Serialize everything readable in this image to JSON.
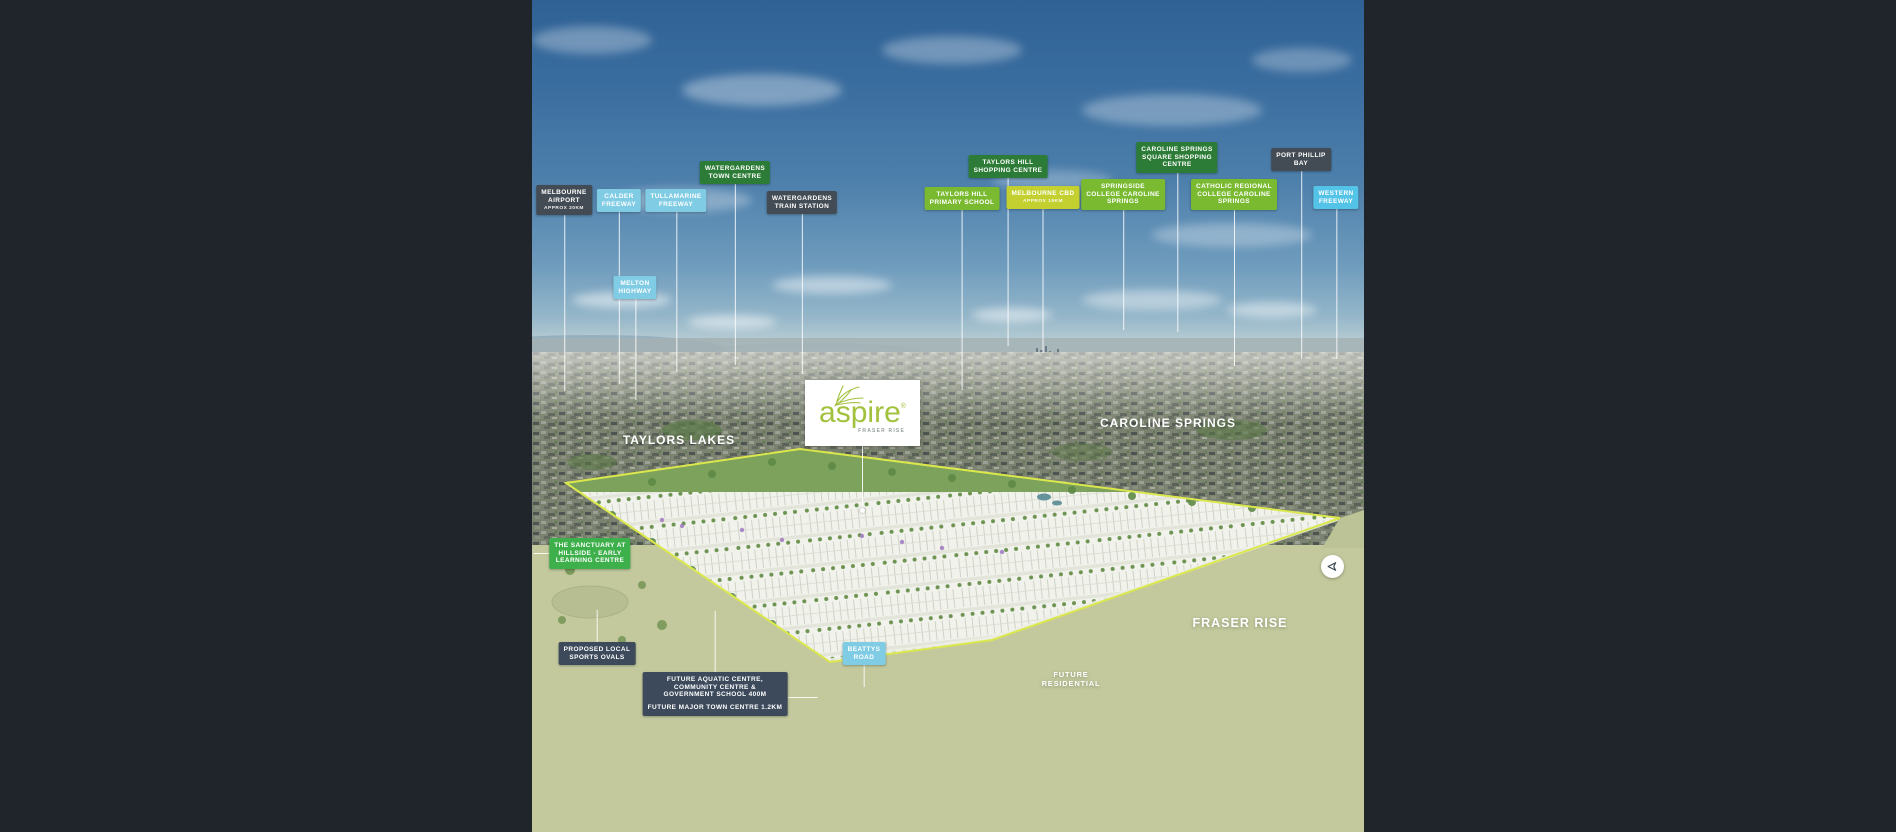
{
  "canvas": {
    "bg": "#20242b"
  },
  "palette": {
    "dark": "#434b54",
    "slate": "#3c4a5b",
    "blue": "#7fcce4",
    "cyan": "#54c3e8",
    "greenDark": "#2c7b36",
    "greenLight": "#7aba31",
    "greenBright": "#3eb04b",
    "yellow": "#c3d02f",
    "boundary": "#dbe84d",
    "leader": "rgba(255,255,255,0.85)"
  },
  "logo": {
    "brand": "aspire",
    "reg": "®",
    "sub": "FRASER RISE"
  },
  "share": {
    "icon": "send-icon"
  },
  "regions": [
    {
      "id": "taylors-lakes",
      "lines": [
        "TAYLORS LAKES"
      ],
      "cx": 147,
      "y": 433,
      "fs": 12,
      "ls": 1
    },
    {
      "id": "caroline-springs",
      "lines": [
        "CAROLINE SPRINGS"
      ],
      "cx": 636,
      "y": 416,
      "fs": 12,
      "ls": 1
    },
    {
      "id": "fraser-rise",
      "lines": [
        "FRASER RISE"
      ],
      "cx": 708,
      "y": 616,
      "fs": 12.5,
      "ls": 1
    },
    {
      "id": "future-residential",
      "lines": [
        "FUTURE",
        "RESIDENTIAL"
      ],
      "cx": 539,
      "y": 670,
      "fs": 7.5,
      "ls": 0.8
    }
  ],
  "callouts": [
    {
      "id": "melbourne-airport",
      "color": "dark",
      "cx": 32,
      "y": 185,
      "lines": [
        "MELBOURNE",
        "AIRPORT"
      ],
      "sub": "APPROX 20KM",
      "leaders": [
        {
          "dir": "down",
          "len": 176
        }
      ]
    },
    {
      "id": "calder-freeway",
      "color": "blue",
      "cx": 87,
      "y": 189,
      "lines": [
        "CALDER",
        "FREEWAY"
      ],
      "leaders": [
        {
          "dir": "down",
          "len": 172
        }
      ]
    },
    {
      "id": "tullamarine-freeway",
      "color": "blue",
      "cx": 144,
      "y": 189,
      "lines": [
        "TULLAMARINE",
        "FREEWAY"
      ],
      "leaders": [
        {
          "dir": "down",
          "len": 160
        }
      ]
    },
    {
      "id": "watergardens-town-centre",
      "color": "greenDark",
      "cx": 203,
      "y": 161,
      "lines": [
        "WATERGARDENS",
        "TOWN CENTRE"
      ],
      "leaders": [
        {
          "dir": "down",
          "len": 181
        }
      ]
    },
    {
      "id": "watergardens-train-station",
      "color": "dark",
      "cx": 270,
      "y": 191,
      "lines": [
        "WATERGARDENS",
        "TRAIN STATION"
      ],
      "leaders": [
        {
          "dir": "down",
          "len": 160
        }
      ]
    },
    {
      "id": "melton-highway",
      "color": "blue",
      "cx": 103,
      "y": 276,
      "lines": [
        "MELTON",
        "HIGHWAY"
      ],
      "leaders": [
        {
          "dir": "down",
          "len": 101
        }
      ]
    },
    {
      "id": "taylors-hill-primary-school",
      "color": "greenLight",
      "cx": 430,
      "y": 187,
      "lines": [
        "TAYLORS HILL",
        "PRIMARY SCHOOL"
      ],
      "leaders": [
        {
          "dir": "down",
          "len": 180
        }
      ]
    },
    {
      "id": "taylors-hill-shopping-centre",
      "color": "greenDark",
      "cx": 476,
      "y": 155,
      "lines": [
        "TAYLORS HILL",
        "SHOPPING CENTRE"
      ],
      "leaders": [
        {
          "dir": "down",
          "len": 168
        }
      ]
    },
    {
      "id": "melbourne-cbd",
      "color": "yellow",
      "cx": 511,
      "y": 186,
      "lines": [
        "MELBOURNE CBD"
      ],
      "sub": "APPROX 19KM",
      "leaders": [
        {
          "dir": "down",
          "len": 144
        }
      ]
    },
    {
      "id": "springside-college-caroline-springs",
      "color": "greenLight",
      "cx": 591,
      "y": 179,
      "lines": [
        "SPRINGSIDE",
        "COLLEGE CAROLINE",
        "SPRINGS"
      ],
      "leaders": [
        {
          "dir": "down",
          "len": 120
        }
      ]
    },
    {
      "id": "caroline-springs-square-shopping-centre",
      "color": "greenDark",
      "cx": 645,
      "y": 142,
      "lines": [
        "CAROLINE SPRINGS",
        "SQUARE SHOPPING",
        "CENTRE"
      ],
      "leaders": [
        {
          "dir": "down",
          "len": 159
        }
      ]
    },
    {
      "id": "catholic-regional-college-caroline-springs",
      "color": "greenLight",
      "cx": 702,
      "y": 179,
      "lines": [
        "CATHOLIC REGIONAL",
        "COLLEGE CAROLINE",
        "SPRINGS"
      ],
      "leaders": [
        {
          "dir": "down",
          "len": 156
        }
      ]
    },
    {
      "id": "port-phillip-bay",
      "color": "dark",
      "cx": 769,
      "y": 148,
      "lines": [
        "PORT PHILLIP",
        "BAY"
      ],
      "leaders": [
        {
          "dir": "down",
          "len": 188
        }
      ]
    },
    {
      "id": "western-freeway",
      "color": "cyan",
      "cx": 804,
      "y": 186,
      "lines": [
        "WESTERN",
        "FREEWAY"
      ],
      "leaders": [
        {
          "dir": "down",
          "len": 150
        }
      ]
    },
    {
      "id": "the-sanctuary-at-hillside",
      "color": "greenBright",
      "cx": 58,
      "y": 538,
      "lines": [
        "THE SANCTUARY AT",
        "HILLSIDE - EARLY",
        "LEARNING CENTRE"
      ],
      "leaders": [
        {
          "dir": "left",
          "len": 16
        }
      ]
    },
    {
      "id": "proposed-local-sports-ovals",
      "color": "slate",
      "cx": 65,
      "y": 642,
      "lines": [
        "PROPOSED LOCAL",
        "SPORTS OVALS"
      ],
      "leaders": [
        {
          "dir": "up",
          "len": 32
        }
      ]
    },
    {
      "id": "beattys-road",
      "color": "blue",
      "cx": 332,
      "y": 642,
      "lines": [
        "BEATTYS",
        "ROAD"
      ],
      "leaders": [
        {
          "dir": "down",
          "len": 22
        }
      ]
    },
    {
      "id": "future-aquatic-centre",
      "color": "slate",
      "cx": 183,
      "y": 672,
      "lines": [
        "FUTURE AQUATIC CENTRE,",
        "COMMUNITY CENTRE &",
        "GOVERNMENT SCHOOL 400M"
      ],
      "para2": [
        "FUTURE MAJOR TOWN CENTRE 1.2KM"
      ],
      "leaders": [
        {
          "dir": "up",
          "len": 61
        },
        {
          "dir": "right",
          "len": 30
        }
      ]
    }
  ]
}
